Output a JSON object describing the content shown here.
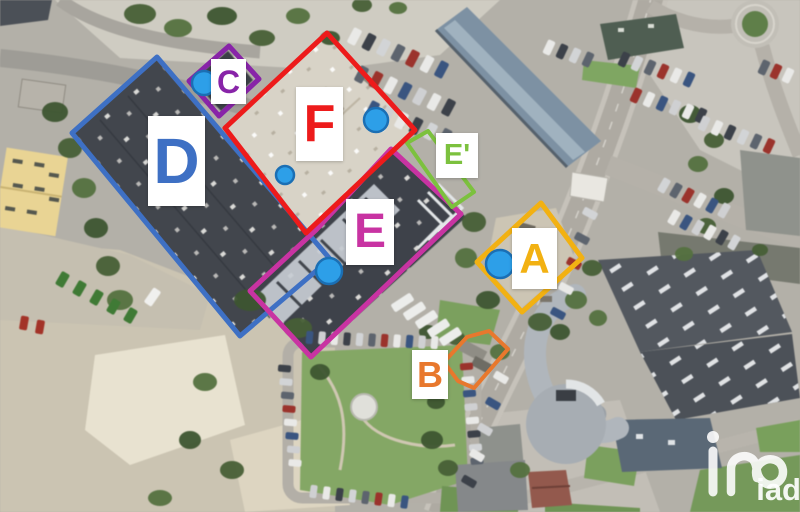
{
  "page": {
    "type": "annotated-aerial-site-plan"
  },
  "watermark": {
    "brand": "iad",
    "monogram": "in-monogram"
  },
  "marker_style": {
    "dot_fill": "#2D9FE8",
    "dot_stroke": "#1B6FB4"
  },
  "zones": [
    {
      "id": "a",
      "label": "A",
      "color": "#F2B112",
      "stroke_width": 5,
      "points": "541,203 582,258 522,312 477,262",
      "box": {
        "x": 512,
        "y": 228,
        "w": 45,
        "h": 61,
        "font": 42
      }
    },
    {
      "id": "b",
      "label": "B",
      "color": "#E8782D",
      "stroke_width": 4,
      "points": "489,331 508,349 474,388 458,381 444,362 467,337",
      "box": {
        "x": 412,
        "y": 350,
        "w": 36,
        "h": 49,
        "font": 36
      }
    },
    {
      "id": "c",
      "label": "C",
      "color": "#8824A8",
      "stroke_width": 5,
      "points": "229,46 259,79 219,116 189,81",
      "box": {
        "x": 211,
        "y": 59,
        "w": 35,
        "h": 45,
        "font": 32
      }
    },
    {
      "id": "d",
      "label": "D",
      "color": "#3E70C4",
      "stroke_width": 5,
      "points": "157,57 330,259 240,336 72,133",
      "box": {
        "x": 148,
        "y": 116,
        "w": 57,
        "h": 90,
        "font": 64
      }
    },
    {
      "id": "e",
      "label": "E",
      "color": "#C833A2",
      "stroke_width": 5,
      "points": "316,230 391,149 461,214 311,357 250,291",
      "box": {
        "x": 346,
        "y": 199,
        "w": 48,
        "h": 66,
        "font": 48
      }
    },
    {
      "id": "e-prime",
      "label": "E'",
      "color": "#7CC13E",
      "stroke_width": 4,
      "points": "407,143 428,131 474,192 452,207",
      "box": {
        "x": 436,
        "y": 133,
        "w": 42,
        "h": 45,
        "font": 29
      }
    },
    {
      "id": "f",
      "label": "F",
      "color": "#ED1B1B",
      "stroke_width": 5,
      "points": "327,33 415,130 306,233 225,128",
      "box": {
        "x": 296,
        "y": 87,
        "w": 47,
        "h": 74,
        "font": 52
      }
    }
  ],
  "dots": [
    {
      "id": "dot-c",
      "cx": 204,
      "cy": 83,
      "r": 12
    },
    {
      "id": "dot-f-right",
      "cx": 376,
      "cy": 120,
      "r": 12
    },
    {
      "id": "dot-f-left",
      "cx": 285,
      "cy": 175,
      "r": 9
    },
    {
      "id": "dot-e",
      "cx": 329,
      "cy": 271,
      "r": 13
    },
    {
      "id": "dot-a",
      "cx": 500,
      "cy": 264,
      "r": 14
    }
  ]
}
